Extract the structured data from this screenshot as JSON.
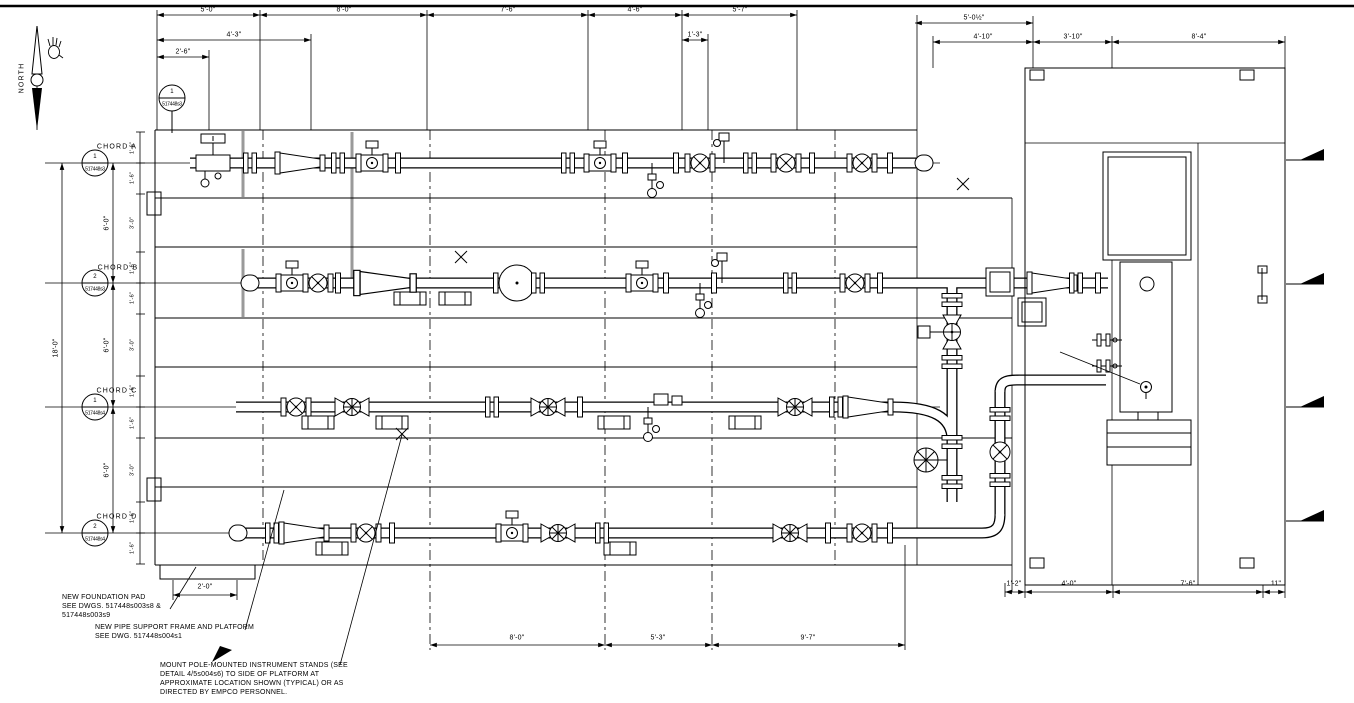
{
  "compass": {
    "label": "NORTH"
  },
  "top_balloon": {
    "num": "1",
    "ref": "517448s3"
  },
  "chords": [
    {
      "label": "CHORD A",
      "balloon_num": "1",
      "balloon_ref": "517448s3"
    },
    {
      "label": "CHORD B",
      "balloon_num": "2",
      "balloon_ref": "517448s3"
    },
    {
      "label": "CHORD C",
      "balloon_num": "1",
      "balloon_ref": "517448s4"
    },
    {
      "label": "CHORD D",
      "balloon_num": "2",
      "balloon_ref": "517448s4"
    }
  ],
  "dims": {
    "top1": [
      "5'-0\"",
      "8'-0\"",
      "7'-6\"",
      "4'-6\"",
      "5'-7\"",
      "5'-0½\""
    ],
    "top2": [
      "4'-3\"",
      "1'-3\"",
      "4'-10\"",
      "3'-10\"",
      "8'-4\""
    ],
    "top3": [
      "2'-6\""
    ],
    "left_overall": "18'-0\"",
    "left_bays": [
      "6'-0\"",
      "6'-0\"",
      "6'-0\""
    ],
    "left_inner": [
      "1'-6\"",
      "1'-6\"",
      "3'-0\"",
      "1'-6\"",
      "1'-6\"",
      "3'-0\"",
      "1'-6\"",
      "1'-6\"",
      "3'-0\"",
      "1'-6\"",
      "1'-6\""
    ],
    "bottom": [
      "8'-0\"",
      "5'-3\"",
      "9'-7\""
    ],
    "bottom_left": "2'-0\"",
    "bottom_right": [
      "1'-2\"",
      "4'-0\"",
      "7'-6\"",
      "11\""
    ]
  },
  "notes": [
    {
      "lines": [
        "NEW FOUNDATION PAD",
        "SEE DWGS. 517448s003s8 &",
        "517448s003s9"
      ]
    },
    {
      "lines": [
        "NEW PIPE SUPPORT FRAME AND PLATFORM",
        "SEE DWG. 517448s004s1"
      ]
    },
    {
      "lines": [
        "MOUNT POLE-MOUNTED INSTRUMENT STANDS (SEE",
        "DETAIL 4/5s004s6) TO SIDE OF PLATFORM AT",
        "APPROXIMATE LOCATION SHOWN (TYPICAL) OR AS",
        "DIRECTED BY EMPCO PERSONNEL."
      ]
    }
  ]
}
